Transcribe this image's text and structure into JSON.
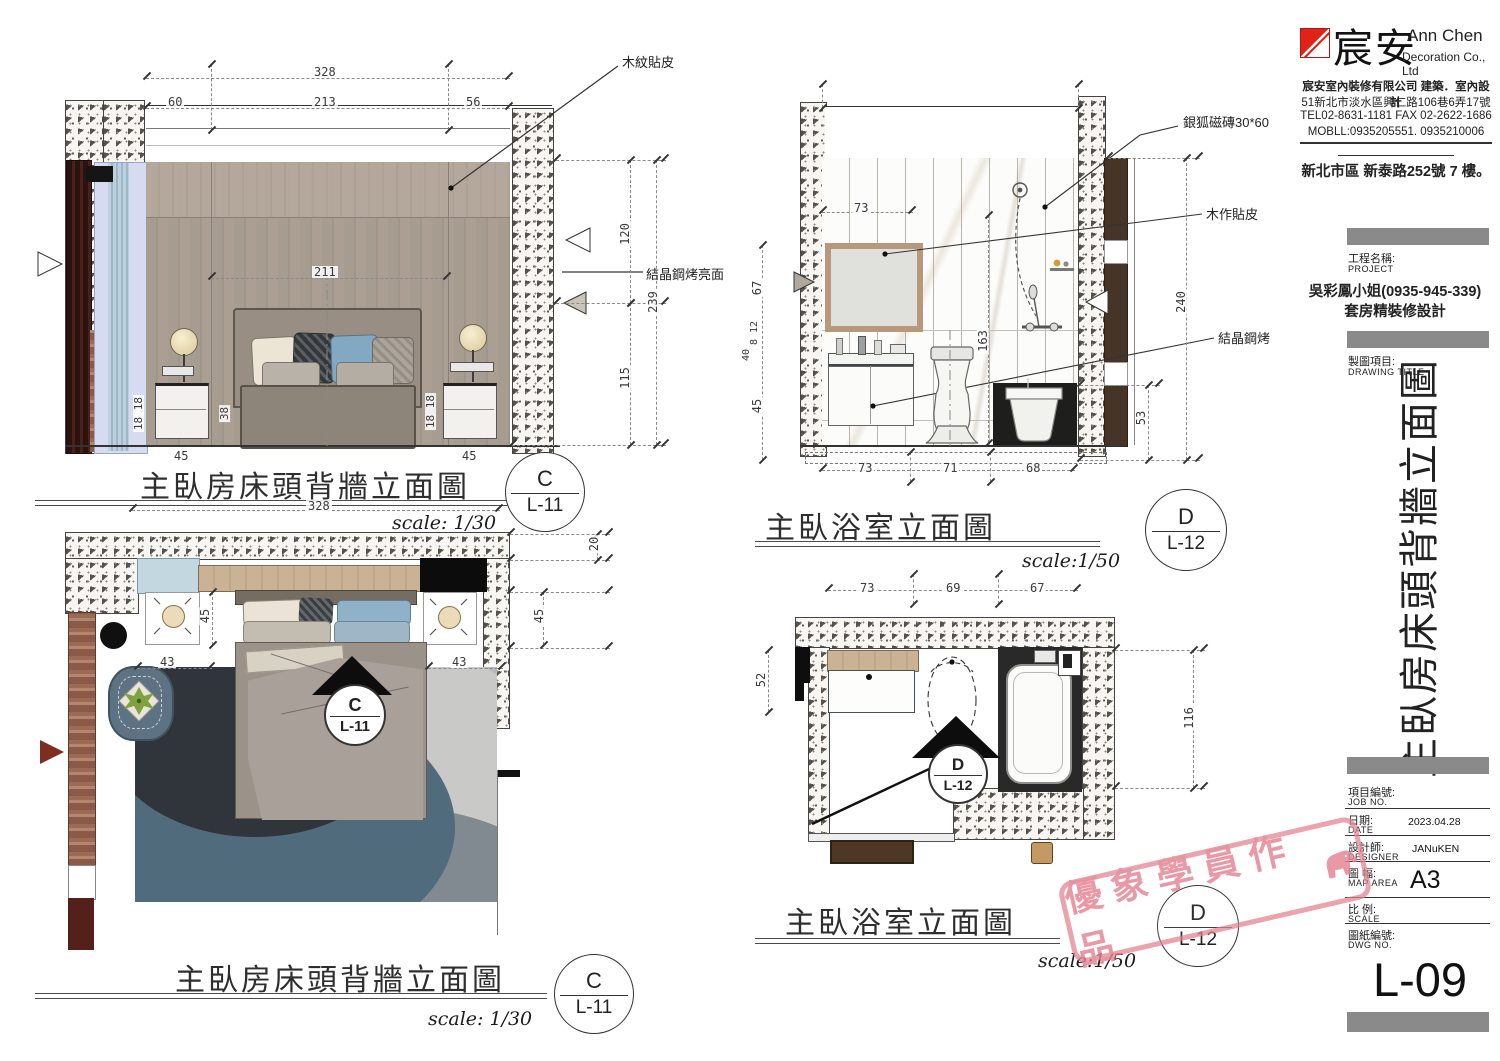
{
  "company": {
    "logo_cn": "宸安",
    "logo_en1": "Ann Chen",
    "logo_en2": "Decoration Co., Ltd",
    "info1": "宸安室內裝修有限公司 建築．室內設計",
    "info2": "51新北市淡水區興仁路106巷6弄17號",
    "info3": "TEL02-8631-1181 FAX 02-2622-1686",
    "info4": "MOBLL:0935205551. 0935210006",
    "site": "新北市區 新泰路252號 7 樓。"
  },
  "titleblock": {
    "project_label": "工程名稱:",
    "project_en": "PROJECT",
    "client": "吳彩鳳小姐(0935-945-339)",
    "project_name": "套房精裝修設計",
    "drawing_label": "製圖項目:",
    "drawing_en": "DRAWING TITLE",
    "vertical_title": "主臥房床頭背牆立面圖",
    "job_label": "項目編號:",
    "job_en": "JOB NO.",
    "date_label": "日期:",
    "date_en": "DATE",
    "date_value": "2023.04.28",
    "designer_label": "設計師:",
    "designer_en": "DESIGNER",
    "designer_value": "JANuKEN",
    "map_label": "圖 幅:",
    "map_en": "MAP AREA",
    "map_value": "A3",
    "scale_label": "比 例:",
    "scale_en": "SCALE",
    "dwg_label": "圖紙編號:",
    "dwg_en": "DWG NO.",
    "sheet_no": "L-09"
  },
  "stamp": {
    "text": "優象學員作品"
  },
  "bed_elev": {
    "title": "主臥房床頭背牆立面圖",
    "scale": "scale: 1/30",
    "marker_letter": "C",
    "marker_sheet": "L-11",
    "label_wood": "木紋貼皮",
    "label_crystal": "結晶鋼烤亮面",
    "d_total": "328",
    "d_seg1": "60",
    "d_seg2": "213",
    "d_seg3": "56",
    "d_inner": "211",
    "d_h1": "120",
    "d_htotal": "239",
    "d_h2": "115",
    "d_ns_l": "18 18",
    "d_ns_r": "18 18",
    "d_bed": "38",
    "d_45l": "45",
    "d_45r": "45"
  },
  "bed_plan": {
    "title": "主臥房床頭背牆立面圖",
    "scale": "scale: 1/30",
    "marker_letter": "C",
    "marker_sheet": "L-11",
    "d_total": "328",
    "d_head": "45",
    "d_43l": "43",
    "d_43r": "43",
    "d_20": "20",
    "d_45r": "45"
  },
  "bath_elev": {
    "title": "主臥浴室立面圖",
    "scale": "scale:1/50",
    "marker_letter": "D",
    "marker_sheet": "L-12",
    "label_tile": "銀狐磁磚30*60",
    "label_wood": "木作貼皮",
    "label_crystal": "結晶鋼烤",
    "d_top": "73",
    "d_l1": "67",
    "d_l2": "8 12",
    "d_l3": "40",
    "d_l4": "45",
    "d_mid": "163",
    "d_r1": "240",
    "d_r2": "53",
    "d_b1": "73",
    "d_b2": "71",
    "d_b3": "68"
  },
  "bath_plan": {
    "title": "主臥浴室立面圖",
    "scale": "scale:1/50",
    "marker_letter": "D",
    "marker_sheet": "L-12",
    "d_t1": "73",
    "d_t2": "69",
    "d_t3": "67",
    "d_left": "52",
    "d_right": "116"
  }
}
